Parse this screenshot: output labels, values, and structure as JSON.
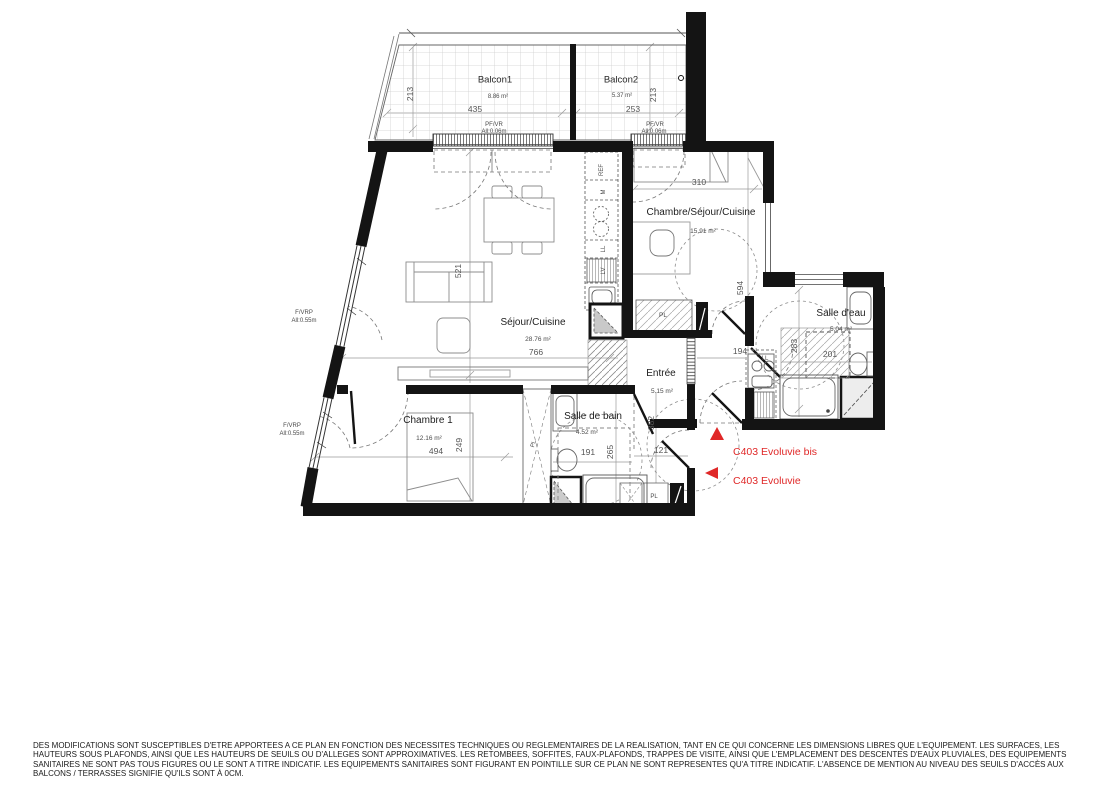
{
  "balconies": [
    {
      "name": "Balcon1",
      "area": "8.86 m²",
      "width": "435",
      "depth": "213",
      "opening": "PF/VR",
      "sill": "All:0.06m"
    },
    {
      "name": "Balcon2",
      "area": "5.37 m²",
      "width": "253",
      "depth": "213",
      "opening": "PF/VR",
      "sill": "All:0.06m"
    }
  ],
  "rooms": {
    "sejour": {
      "name": "Séjour/Cuisine",
      "area": "28.76 m²",
      "width": "766",
      "height": "521"
    },
    "studio": {
      "name": "Chambre/Séjour/Cuisine",
      "area": "15.91 m²",
      "width": "310",
      "height": "594"
    },
    "salle_deau": {
      "name": "Salle d'eau",
      "area": "5.04 m²",
      "width": "201",
      "height": "283"
    },
    "entree": {
      "name": "Entrée",
      "area": "5.15 m²",
      "width": "121",
      "height": "382",
      "side": "194"
    },
    "salle_de_bain": {
      "name": "Salle de bain",
      "area": "4.52 m²",
      "width": "191",
      "height": "265"
    },
    "chambre1": {
      "name": "Chambre 1",
      "area": "12.16 m²",
      "width": "494",
      "height": "249"
    }
  },
  "windows": {
    "window1": {
      "label": "F/VRP",
      "sill": "All:0.55m"
    },
    "window2": {
      "label": "F/VRP",
      "sill": "All:0.55m"
    }
  },
  "closets": {
    "studio_closet": "PL",
    "bedroom_closet": "PL",
    "entry_closet": "PL"
  },
  "appliances": {
    "fridge": "REF",
    "microwave": "M",
    "washer": "LL",
    "dishwasher": "LV",
    "studio_washer": "LL"
  },
  "units": {
    "bis": "C403 Evoluvie bis",
    "main": "C403 Evoluvie"
  },
  "colors": {
    "accent_red": "#e02828",
    "wall": "#141414"
  },
  "footer": {
    "line1": "DES MODIFICATIONS SONT SUSCEPTIBLES D'ETRE APPORTEES A CE PLAN EN FONCTION DES NECESSITES TECHNIQUES OU REGLEMENTAIRES DE LA REALISATION, TANT EN CE QUI CONCERNE LES DIMENSIONS LIBRES QUE L'EQUIPEMENT. LES SURFACES, LES",
    "line2": "HAUTEURS SOUS PLAFONDS, AINSI QUE LES HAUTEURS DE SEUILS OU D'ALLEGES SONT APPROXIMATIVES. LES RETOMBEES, SOFFITES, FAUX-PLAFONDS, TRAPPES DE VISITE, AINSI QUE L'EMPLACEMENT DES DESCENTES D'EAUX PLUVIALES, DES EQUIPEMENTS",
    "line3": "SANITAIRES NE SONT PAS TOUS FIGURES OU LE SONT A TITRE INDICATIF. LES EQUIPEMENTS SANITAIRES SONT FIGURANT EN POINTILLE SUR CE PLAN NE SONT REPRESENTES QU'A TITRE INDICATIF. L'ABSENCE DE MENTION AU NIVEAU DES SEUILS D'ACCÈS AUX",
    "line4": "BALCONS / TERRASSES SIGNIFIE QU'ILS SONT À 0CM."
  }
}
